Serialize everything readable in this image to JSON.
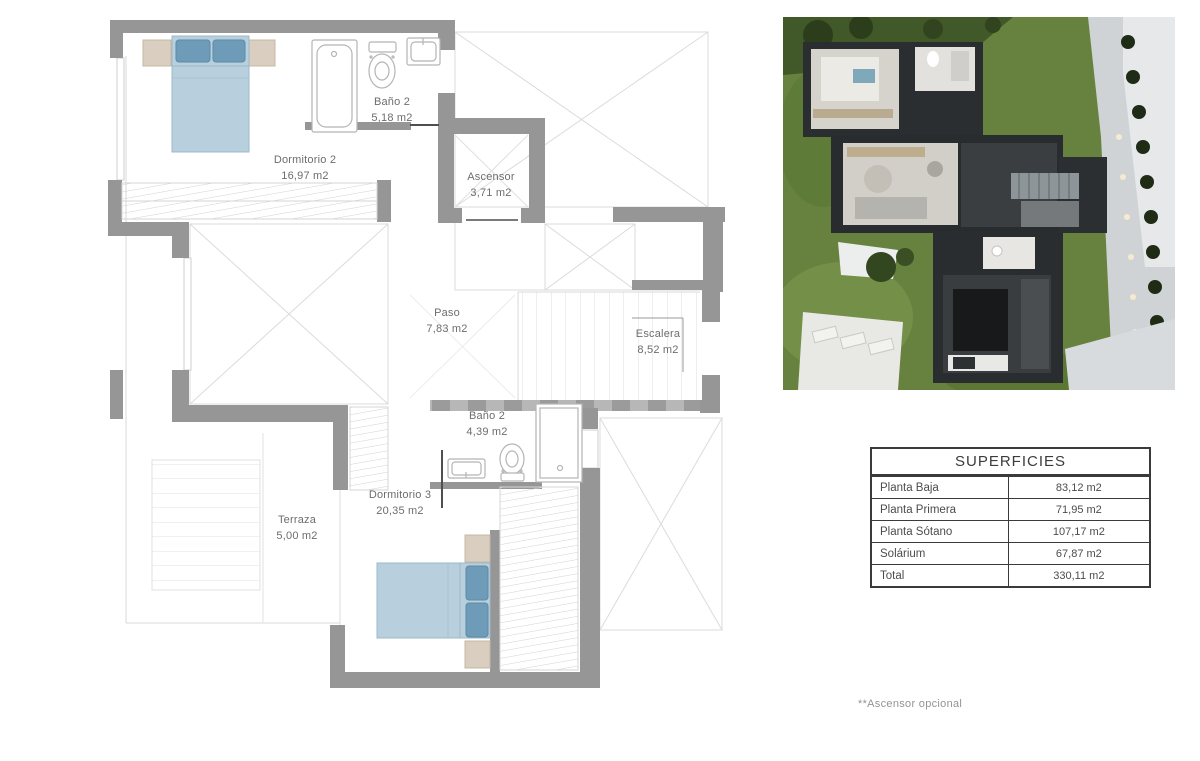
{
  "floor_plan": {
    "rooms": [
      {
        "id": "bano2-top",
        "name": "Baño 2",
        "area": "5,18 m2"
      },
      {
        "id": "dormitorio2",
        "name": "Dormitorio 2",
        "area": "16,97 m2"
      },
      {
        "id": "ascensor",
        "name": "Ascensor",
        "area": "3,71 m2"
      },
      {
        "id": "paso",
        "name": "Paso",
        "area": "7,83 m2"
      },
      {
        "id": "escalera",
        "name": "Escalera",
        "area": "8,52 m2"
      },
      {
        "id": "bano2-lower",
        "name": "Baño 2",
        "area": "4,39 m2"
      },
      {
        "id": "dormitorio3",
        "name": "Dormitorio 3",
        "area": "20,35 m2"
      },
      {
        "id": "terraza",
        "name": "Terraza",
        "area": "5,00 m2"
      }
    ],
    "colors": {
      "wall": "#969696",
      "bed": "#b8cfdd",
      "pillow": "#6e9cb8",
      "nightstand": "#d9cec0",
      "thin_line": "#dbdbdb"
    }
  },
  "superficies_table": {
    "title": "SUPERFICIES",
    "rows": [
      {
        "label": "Planta Baja",
        "value": "83,12 m2"
      },
      {
        "label": "Planta Primera",
        "value": "71,95 m2"
      },
      {
        "label": "Planta Sótano",
        "value": "107,17 m2"
      },
      {
        "label": "Solárium",
        "value": "67,87 m2"
      },
      {
        "label": "Total",
        "value": "330,11 m2"
      }
    ]
  },
  "footnote": "**Ascensor opcional"
}
